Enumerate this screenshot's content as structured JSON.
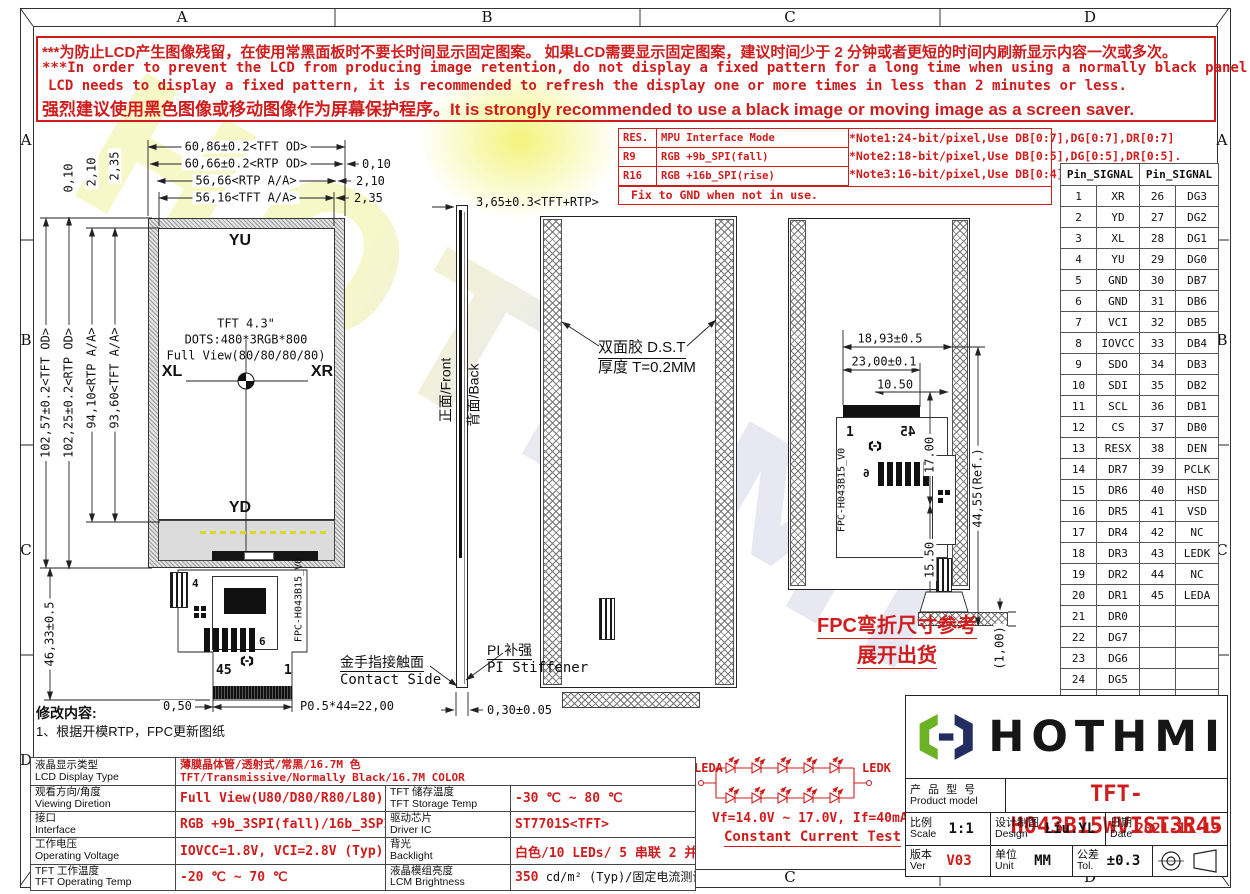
{
  "frame": {
    "cols": [
      "A",
      "B",
      "C",
      "D"
    ],
    "rows": [
      "A",
      "B",
      "C",
      "D"
    ]
  },
  "warning": {
    "line1": "***为防止LCD产生图像残留，在使用常黑面板时不要长时间显示固定图案。 如果LCD需要显示固定图案，建议时间少于 2 分钟或者更短的时间内刷新显示内容一次或多次。",
    "line2": "***In order to prevent the LCD from producing image retention, do not display a fixed pattern for a long time when using a normally black panel. If the",
    "line3": "LCD needs to display a fixed pattern, it is recommended to refresh the display one or more times in less than 2 minutes or less.",
    "line4": "强烈建议使用黑色图像或移动图像作为屏幕保护程序。It is strongly recommended to use a black image or moving image as a screen saver."
  },
  "notes": {
    "rows": [
      [
        "RES.",
        "MPU Interface Mode"
      ],
      [
        "R9",
        "RGB +9b_SPI(fall)"
      ],
      [
        "R16",
        "RGB +16b_SPI(rise)"
      ]
    ],
    "notelines": [
      "*Note1:24-bit/pixel,Use DB[0:7],DG[0:7],DR[0:7]",
      "*Note2:18-bit/pixel,Use DB[0:5],DG[0:5],DR[0:5].",
      "*Note3:16-bit/pixel,Use DB[0:4],DG[0:5],DR[0:4]."
    ],
    "fix": "Fix to GND  when not in use."
  },
  "pin_table": {
    "header": "Pin_SIGNAL",
    "rows": [
      [
        "1",
        "XR",
        "26",
        "DG3"
      ],
      [
        "2",
        "YD",
        "27",
        "DG2"
      ],
      [
        "3",
        "XL",
        "28",
        "DG1"
      ],
      [
        "4",
        "YU",
        "29",
        "DG0"
      ],
      [
        "5",
        "GND",
        "30",
        "DB7"
      ],
      [
        "6",
        "GND",
        "31",
        "DB6"
      ],
      [
        "7",
        "VCI",
        "32",
        "DB5"
      ],
      [
        "8",
        "IOVCC",
        "33",
        "DB4"
      ],
      [
        "9",
        "SDO",
        "34",
        "DB3"
      ],
      [
        "10",
        "SDI",
        "35",
        "DB2"
      ],
      [
        "11",
        "SCL",
        "36",
        "DB1"
      ],
      [
        "12",
        "CS",
        "37",
        "DB0"
      ],
      [
        "13",
        "RESX",
        "38",
        "DEN"
      ],
      [
        "14",
        "DR7",
        "39",
        "PCLK"
      ],
      [
        "15",
        "DR6",
        "40",
        "HSD"
      ],
      [
        "16",
        "DR5",
        "41",
        "VSD"
      ],
      [
        "17",
        "DR4",
        "42",
        "NC"
      ],
      [
        "18",
        "DR3",
        "43",
        "LEDK"
      ],
      [
        "19",
        "DR2",
        "44",
        "NC"
      ],
      [
        "20",
        "DR1",
        "45",
        "LEDA"
      ],
      [
        "21",
        "DR0",
        "",
        ""
      ],
      [
        "22",
        "DG7",
        "",
        ""
      ],
      [
        "23",
        "DG6",
        "",
        ""
      ],
      [
        "24",
        "DG5",
        "",
        ""
      ],
      [
        "25",
        "DG4",
        "",
        ""
      ]
    ]
  },
  "front_view": {
    "label_yu": "YU",
    "label_yd": "YD",
    "label_xl": "XL",
    "label_xr": "XR",
    "center1": "TFT 4.3\"",
    "center2": "DOTS:480*3RGB*800",
    "center3": "Full View(80/80/80/80)",
    "dim_top1": "60,86±0.2<TFT OD>",
    "dim_top2": "60,66±0.2<RTP OD>",
    "dim_top3": "56,66<RTP A/A>",
    "dim_top4": "56,16<TFT A/A>",
    "off_r1": "0,10",
    "off_r2": "2,10",
    "off_r3": "2,35",
    "dim_l1": "102,57±0.2<TFT OD>",
    "dim_l2": "102,25±0.2<RTP OD>",
    "dim_l3": "94,10<RTP A/A>",
    "dim_l4": "93,60<TFT A/A>",
    "off_l1": "0,10",
    "off_l2": "2,10",
    "off_l3": "2,35",
    "dim_fpc_h": "46,33±0.5",
    "fpc_pin45": "45",
    "fpc_pin1": "1",
    "fpc_lbl4": "4",
    "fpc_lbl6": "6",
    "fpc_id": "FPC-H043B15_V0",
    "dim_fpc_left": "0,50",
    "dim_fpc_pitch": "P0.5*44=22,00"
  },
  "side_view": {
    "dim_thickness": "3,65±0.3<TFT+RTP>",
    "front_label": "正面/Front",
    "back_label": "背面/Back",
    "contact_cn": "金手指接触面",
    "contact_en": "Contact Side",
    "stiff_cn": "PI 补强",
    "stiff_en": "PI Stiffener",
    "dim_stiff": "0,30±0.05"
  },
  "back_view": {
    "tape_cn": "双面胶 D.S.T",
    "tape_t": "厚度 T=0.2MM"
  },
  "fpc_view": {
    "dim1": "18,93±0.5",
    "dim2": "23,00±0.1",
    "dim3": "10.50",
    "dim4": "17.00",
    "dim5": "15.50",
    "dim6": "44,55(Ref.)",
    "dim7": "(1,00)",
    "pin1": "1",
    "pin45": "45",
    "lbl6": "6",
    "fpc_id": "FPC-H043B15_V0",
    "note1": "FPC弯折尺寸参考",
    "note2": "展开出货"
  },
  "led": {
    "left": "LEDA",
    "right": "LEDK",
    "spec": "Vf=14.0V ~ 17.0V, If=40mA",
    "test": "Constant Current Test"
  },
  "revision": {
    "title": "修改内容:",
    "item1": "1、根据开模RTP，FPC更新图纸"
  },
  "specs": {
    "rows": [
      {
        "cn": "液晶显示类型",
        "en": "LCD Display Type",
        "val_cn": "薄膜晶体管/透射式/常黑/16.7M 色",
        "val_en": "TFT/Transmissive/Normally Black/16.7M COLOR"
      },
      {
        "cn": "观看方向/角度",
        "en": "Viewing Diretion",
        "val": "Full View(U80/D80/R80/L80)",
        "cn2": "TFT 储存温度",
        "en2": "TFT Storage Temp",
        "val2": "-30 ℃ ~ 80 ℃"
      },
      {
        "cn": "接口",
        "en": "Interface",
        "val": "RGB +9b_3SPI(fall)/16b_3SPI(rise)",
        "cn2": "驱动芯片",
        "en2": "Driver IC",
        "val2": "ST7701S<TFT>"
      },
      {
        "cn": "工作电压",
        "en": "Operating Voltage",
        "val": "IOVCC=1.8V, VCI=2.8V (Typ)",
        "cn2": "背光",
        "en2": "Backlight",
        "val2": "白色/10 LEDs/ 5 串联 2 并联"
      },
      {
        "cn": "TFT 工作温度",
        "en": "TFT Operating Temp",
        "val": "-20 ℃ ~ 70 ℃",
        "cn2": "液晶模组亮度",
        "en2": "LCM Brightness",
        "val2_red": "350",
        "val2_rest": " cd/m² (Typ)/固定电流测试"
      }
    ]
  },
  "title_block": {
    "brand": "HOTHMI",
    "model_cn": "产 品 型 号",
    "model_en": "Product model",
    "model": "TFT-H043B15WVIST3R45",
    "scale_cn": "比例",
    "scale_en": "Scale",
    "scale": "1:1",
    "design_cn": "设计制图",
    "design_en": "Design",
    "designer": "Liu.YL",
    "date_cn": "日期",
    "date_en": "Date",
    "date": "2021-11-19",
    "ver_cn": "版本",
    "ver_en": "Ver",
    "version": "V03",
    "unit_cn": "单位",
    "unit_en": "Unit",
    "unit": "MM",
    "tol_cn": "公差",
    "tol_en": "Tol.",
    "tolerance": "±0.3"
  },
  "watermark": {
    "text": "HOTHMI"
  },
  "colors": {
    "accent_red": "#cf1d1d",
    "logo_green": "#6db224",
    "logo_navy": "#232d62"
  }
}
